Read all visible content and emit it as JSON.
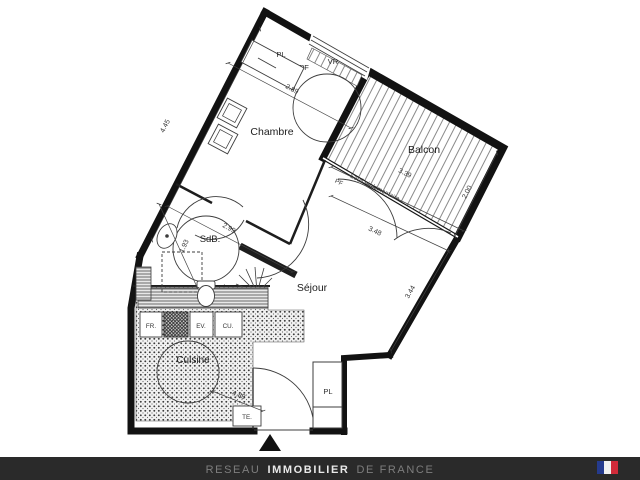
{
  "plan": {
    "rooms": {
      "chambre": {
        "name": "Chambre",
        "dim_length": "4.45",
        "dim_width": "2.89"
      },
      "balcon": {
        "name": "Balcon",
        "dim_length": "3.39",
        "dim_depth": "2.00"
      },
      "sdb": {
        "name": "SdB.",
        "dim_length": "2.99",
        "dim_width": "1.93"
      },
      "sejour": {
        "name": "Séjour",
        "dim_top": "3.48",
        "dim_right": "3.44"
      },
      "cuisine": {
        "name": "Cuisine",
        "dim": "4.88"
      }
    },
    "labels": {
      "closet_top": "PL",
      "closet_bottom": "PL",
      "window_type": "PF",
      "shutter": "VR",
      "threshold_window": "PF",
      "threshold_note": "Seuil réglementaire",
      "fridge": "FR.",
      "sink": "EV.",
      "cooktop": "CU.",
      "electrical": "TE."
    }
  },
  "footer": {
    "part1": "RESEAU",
    "part2": "IMMOBILIER",
    "part3": "DE FRANCE",
    "bar_color": "#2a2a2a",
    "flag": {
      "blue": "#253b8e",
      "white": "#f0f0f0",
      "red": "#d02b3a"
    }
  }
}
